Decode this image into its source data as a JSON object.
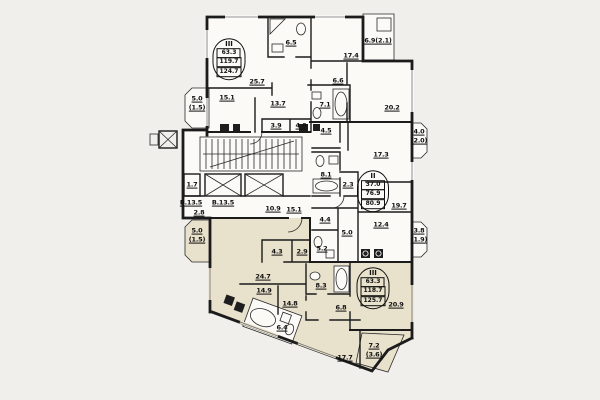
{
  "palette": {
    "background": "#f0efeb",
    "paper": "#fbfaf7",
    "shaded_apartment": "#e8e1cb",
    "wall": "#1b1b1b",
    "label": "#101010"
  },
  "stamps": [
    {
      "roman": "III",
      "values": [
        "63.3",
        "119.7",
        "124.7"
      ],
      "x": 229,
      "y": 59
    },
    {
      "roman": "II",
      "values": [
        "37.0",
        "76.9",
        "80.9"
      ],
      "x": 373,
      "y": 191
    },
    {
      "roman": "III",
      "values": [
        "63.3",
        "118.7",
        "125.7"
      ],
      "x": 373,
      "y": 288
    }
  ],
  "labels": [
    {
      "t": "25.7",
      "x": 257,
      "y": 82
    },
    {
      "t": "15.1",
      "x": 227,
      "y": 98
    },
    {
      "t": "13.7",
      "x": 278,
      "y": 104
    },
    {
      "t": "6.5",
      "x": 291,
      "y": 43
    },
    {
      "t": "3.9",
      "x": 276,
      "y": 126
    },
    {
      "t": "4.0",
      "x": 301,
      "y": 126
    },
    {
      "t": "5.0",
      "x": 197,
      "y": 99
    },
    {
      "t": "(1.5)",
      "x": 197,
      "y": 108
    },
    {
      "t": "17.4",
      "x": 351,
      "y": 56
    },
    {
      "t": "6.9(2.1)",
      "x": 378,
      "y": 41
    },
    {
      "t": "20.2",
      "x": 392,
      "y": 108
    },
    {
      "t": "6.6",
      "x": 338,
      "y": 81
    },
    {
      "t": "7.1",
      "x": 325,
      "y": 105
    },
    {
      "t": "4.5",
      "x": 326,
      "y": 131
    },
    {
      "t": "17.3",
      "x": 381,
      "y": 155
    },
    {
      "t": "4.0",
      "x": 419,
      "y": 132
    },
    {
      "t": "(2.0)",
      "x": 419,
      "y": 141
    },
    {
      "t": "8.1",
      "x": 326,
      "y": 175
    },
    {
      "t": "2.3",
      "x": 348,
      "y": 185
    },
    {
      "t": "19.7",
      "x": 399,
      "y": 206
    },
    {
      "t": "12.4",
      "x": 381,
      "y": 225
    },
    {
      "t": "3.8",
      "x": 419,
      "y": 231
    },
    {
      "t": "(1.9)",
      "x": 419,
      "y": 240
    },
    {
      "t": "4.4",
      "x": 325,
      "y": 220
    },
    {
      "t": "5.0",
      "x": 347,
      "y": 233
    },
    {
      "t": "5.2",
      "x": 322,
      "y": 249
    },
    {
      "t": "1.7",
      "x": 192,
      "y": 185
    },
    {
      "t": "В.13.5",
      "x": 191,
      "y": 203
    },
    {
      "t": "В.13.5",
      "x": 223,
      "y": 203
    },
    {
      "t": "2.8",
      "x": 199,
      "y": 213
    },
    {
      "t": "10.9",
      "x": 273,
      "y": 209
    },
    {
      "t": "15.1",
      "x": 294,
      "y": 210
    },
    {
      "t": "24.7",
      "x": 263,
      "y": 277
    },
    {
      "t": "14.9",
      "x": 264,
      "y": 291
    },
    {
      "t": "4.3",
      "x": 277,
      "y": 252
    },
    {
      "t": "2.9",
      "x": 302,
      "y": 252
    },
    {
      "t": "14.8",
      "x": 290,
      "y": 304
    },
    {
      "t": "6.4",
      "x": 282,
      "y": 328
    },
    {
      "t": "8.3",
      "x": 321,
      "y": 286
    },
    {
      "t": "6.8",
      "x": 341,
      "y": 308
    },
    {
      "t": "20.9",
      "x": 396,
      "y": 305
    },
    {
      "t": "17.7",
      "x": 345,
      "y": 358
    },
    {
      "t": "7.2",
      "x": 374,
      "y": 346
    },
    {
      "t": "(3.6)",
      "x": 374,
      "y": 355
    },
    {
      "t": "5.0",
      "x": 197,
      "y": 231
    },
    {
      "t": "(1.5)",
      "x": 197,
      "y": 240
    }
  ]
}
